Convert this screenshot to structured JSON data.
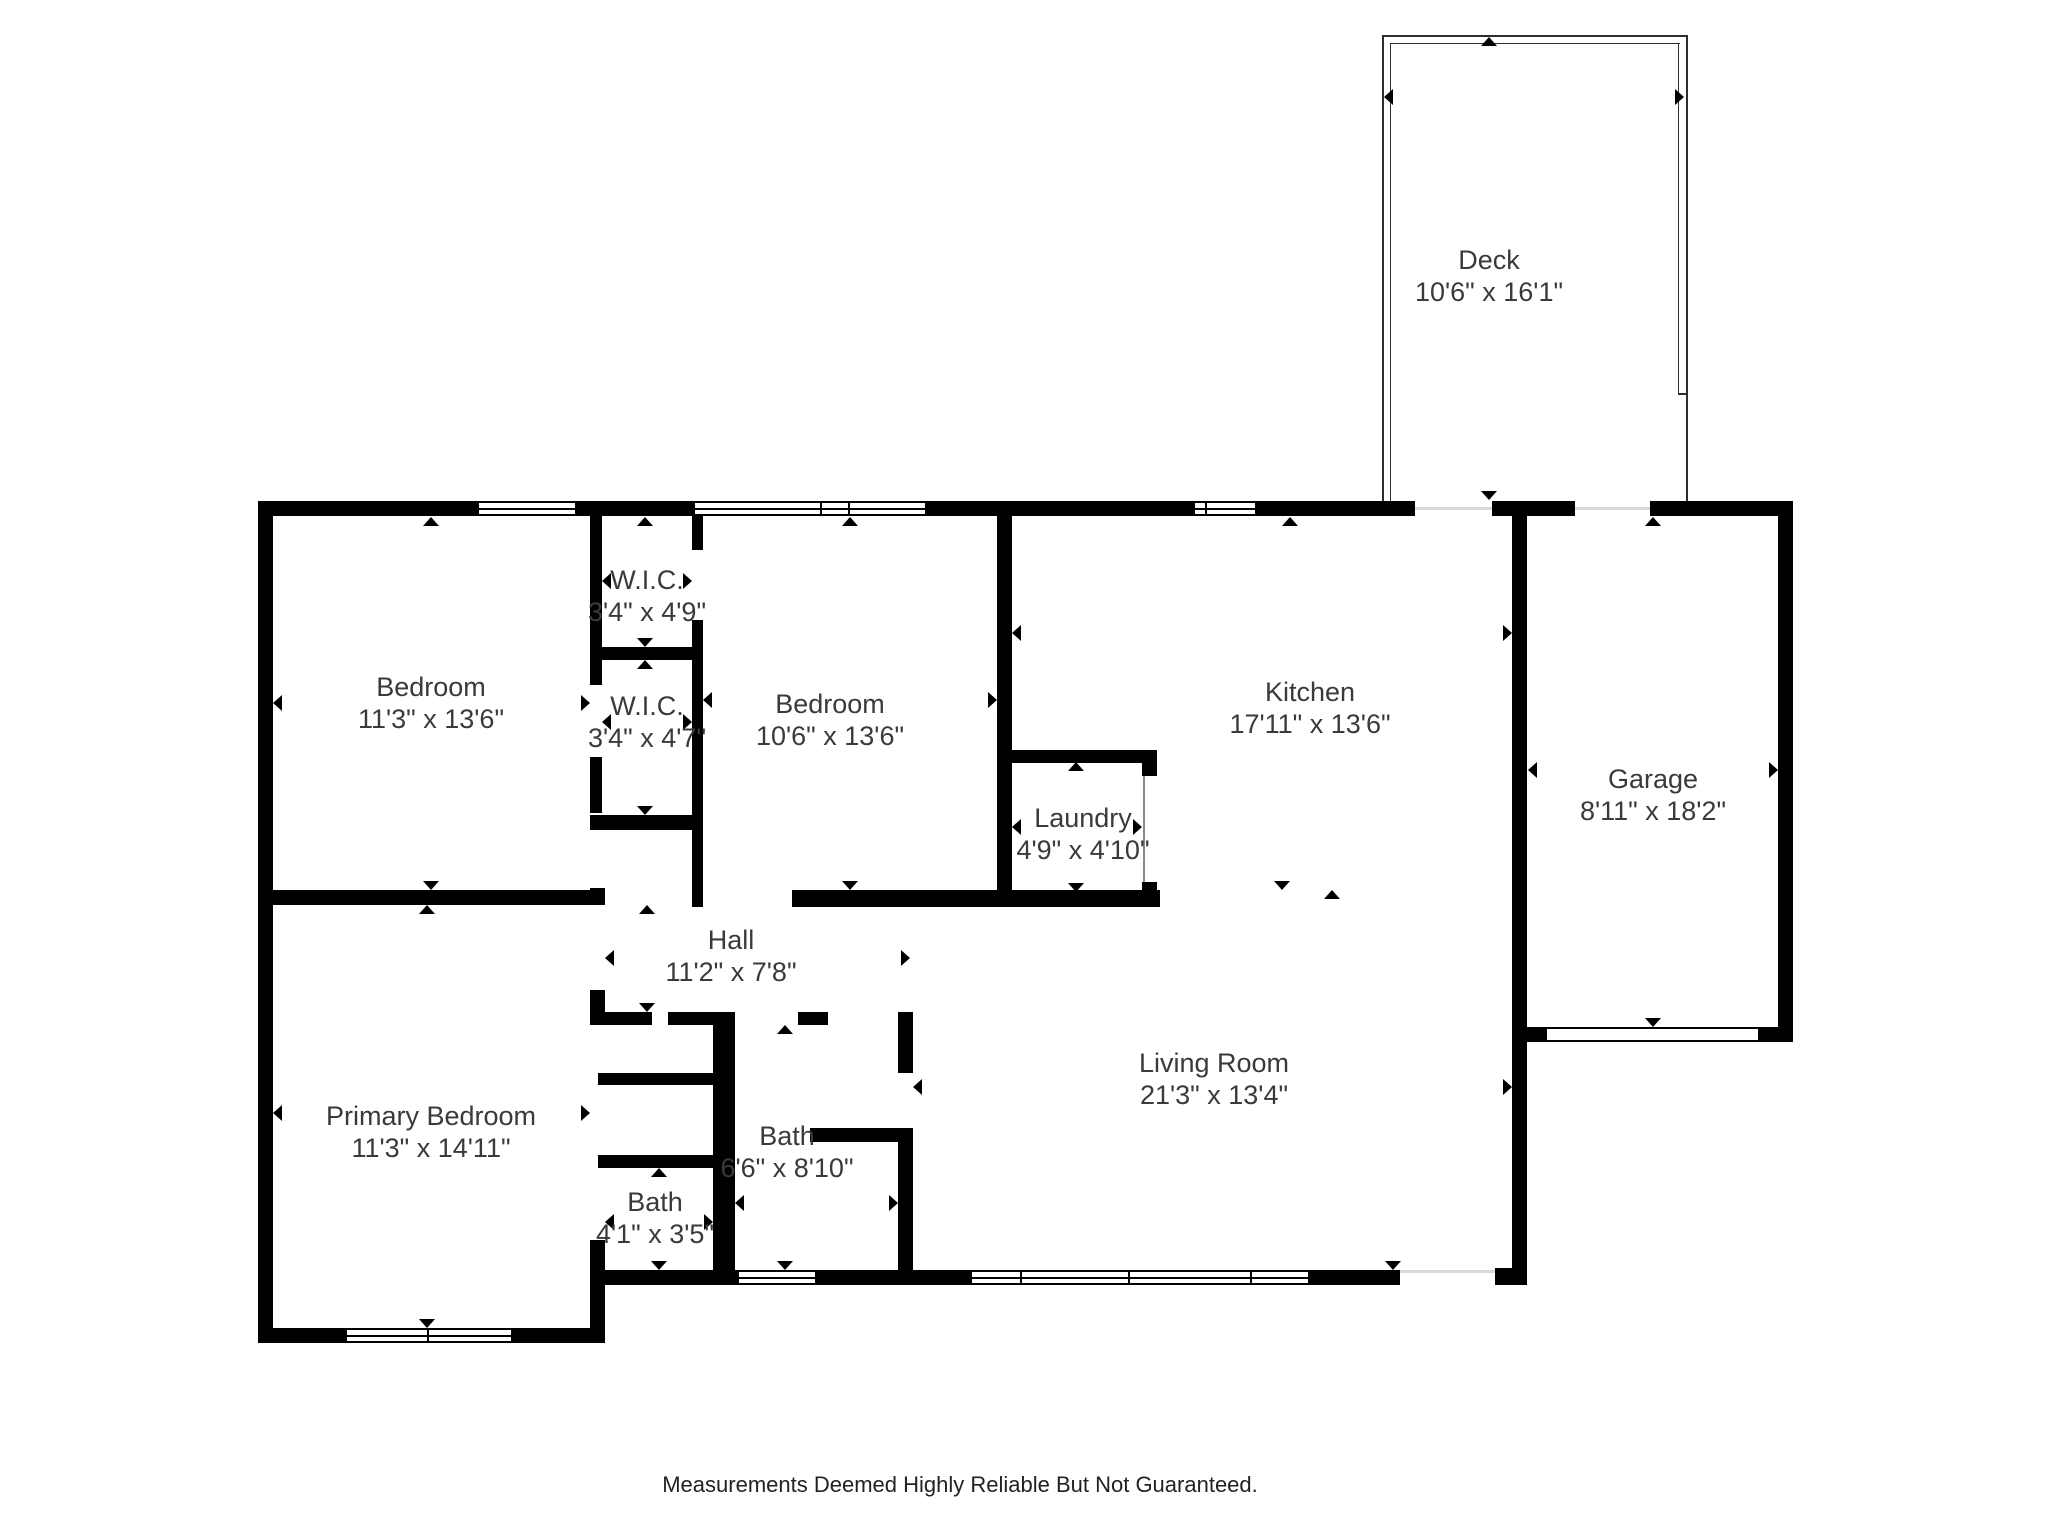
{
  "colors": {
    "background": "#ffffff",
    "wall": "#000000",
    "label": "#3a3a3a",
    "threshold": "#d9d9d9"
  },
  "rooms": {
    "deck": {
      "name": "Deck",
      "dims": "10'6\" x 16'1\""
    },
    "bedroom1": {
      "name": "Bedroom",
      "dims": "11'3\" x 13'6\""
    },
    "wic1": {
      "name": "W.I.C.",
      "dims": "3'4\" x 4'9\""
    },
    "wic2": {
      "name": "W.I.C.",
      "dims": "3'4\" x 4'7\""
    },
    "bedroom2": {
      "name": "Bedroom",
      "dims": "10'6\" x 13'6\""
    },
    "kitchen": {
      "name": "Kitchen",
      "dims": "17'11\" x 13'6\""
    },
    "laundry": {
      "name": "Laundry",
      "dims": "4'9\" x 4'10\""
    },
    "garage": {
      "name": "Garage",
      "dims": "8'11\" x 18'2\""
    },
    "hall": {
      "name": "Hall",
      "dims": "11'2\" x 7'8\""
    },
    "bath_main": {
      "name": "Bath",
      "dims": "6'6\" x 8'10\""
    },
    "bath_ensuite": {
      "name": "Bath",
      "dims": "4'1\" x 3'5\""
    },
    "primary": {
      "name": "Primary Bedroom",
      "dims": "11'3\" x 14'11\""
    },
    "living": {
      "name": "Living Room",
      "dims": "21'3\" x 13'4\""
    }
  },
  "footer": {
    "disclaimer": "Measurements Deemed Highly Reliable But Not Guaranteed."
  }
}
